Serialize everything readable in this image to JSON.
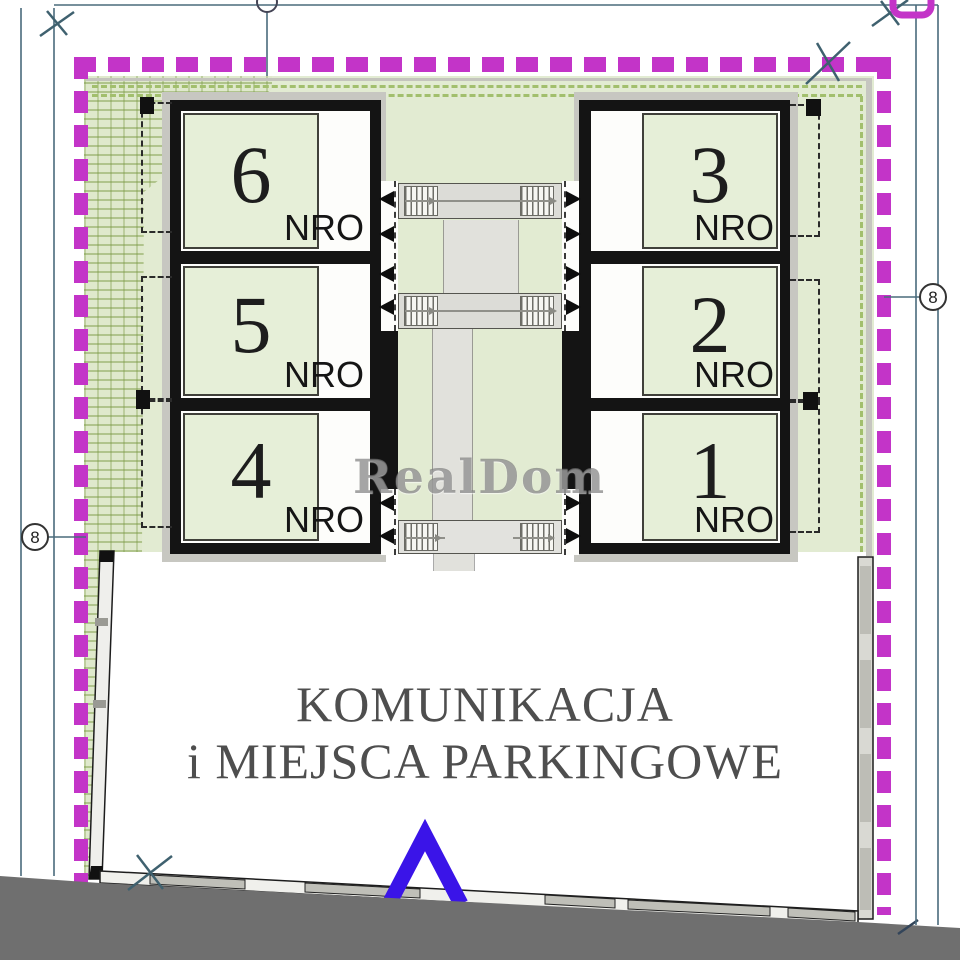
{
  "plan": {
    "watermark": "RealDom",
    "units": [
      {
        "number": "6",
        "area_label": "NRO"
      },
      {
        "number": "5",
        "area_label": "NRO"
      },
      {
        "number": "4",
        "area_label": "NRO"
      },
      {
        "number": "3",
        "area_label": "NRO"
      },
      {
        "number": "2",
        "area_label": "NRO"
      },
      {
        "number": "1",
        "area_label": "NRO"
      }
    ],
    "parking_area": {
      "line1": "KOMUNIKACJA",
      "line2": "i MIEJSCA PARKINGOWE"
    },
    "axis_markers": {
      "left": "8",
      "right": "8"
    },
    "colors": {
      "boundary_magenta": "#c334c8",
      "plot_green": "#e2ebd2",
      "entrance_arrow_blue": "#3a14e8",
      "road_dark_gray": "#6f6f6f"
    }
  }
}
